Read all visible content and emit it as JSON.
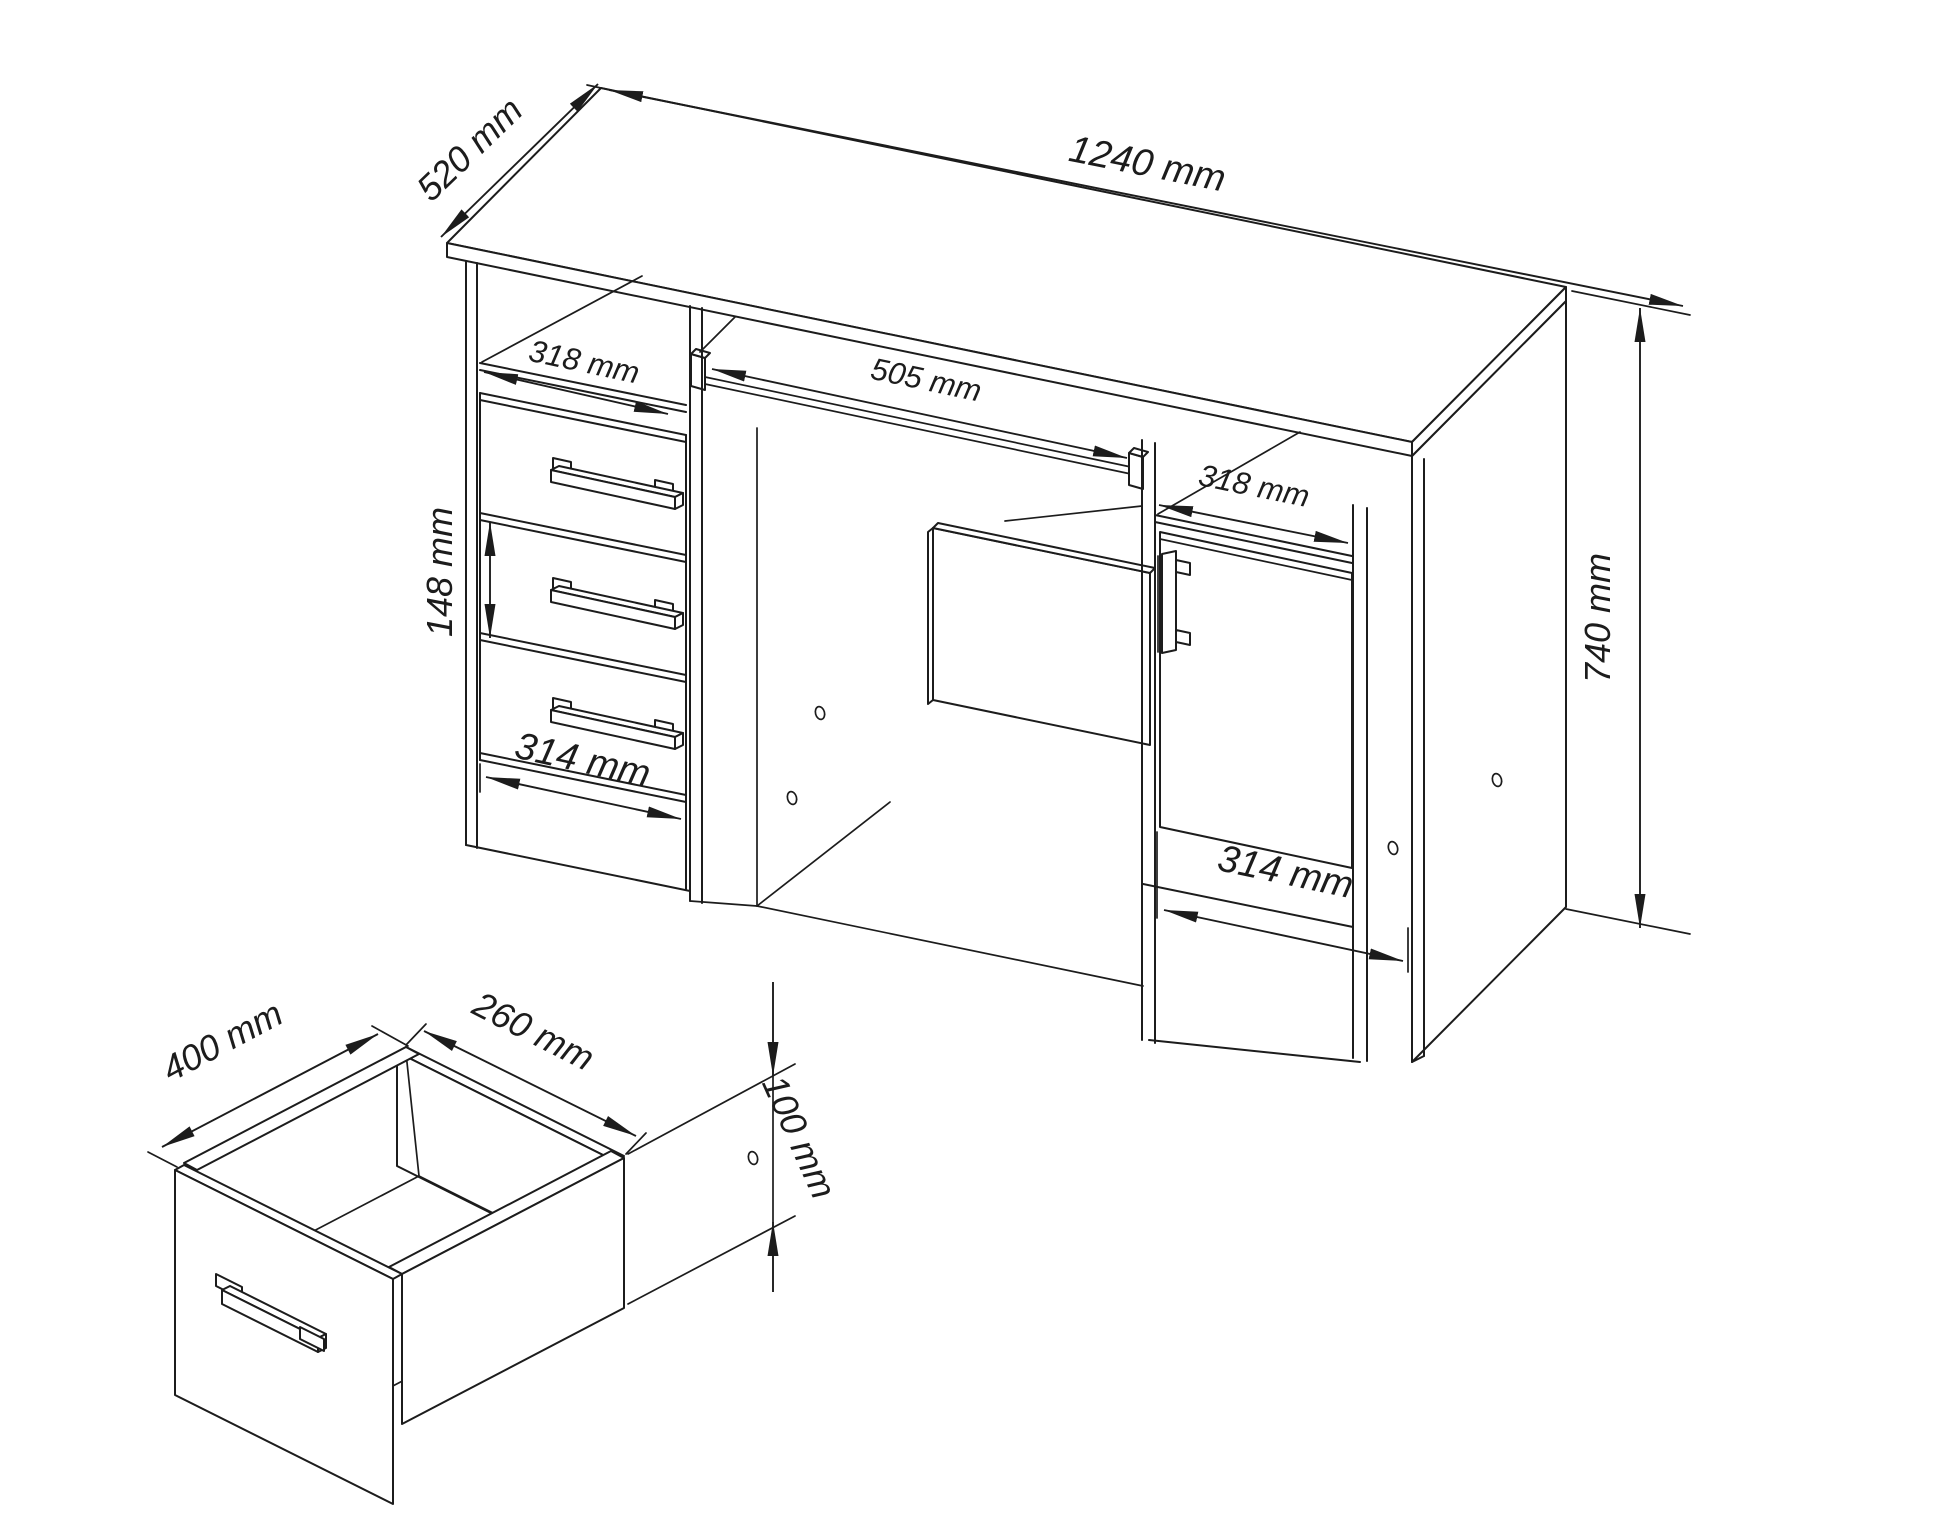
{
  "drawing": {
    "desk": {
      "width_label": "1240 mm",
      "depth_label": "520 mm",
      "height_label": "740 mm",
      "left_shelf_width_label": "318 mm",
      "tray_width_label": "505 mm",
      "right_shelf_width_label": "318 mm",
      "drawer_pitch_label": "148 mm",
      "drawer_front_width_label": "314 mm",
      "door_width_label": "314 mm"
    },
    "drawer_detail": {
      "depth_label": "400 mm",
      "width_label": "260 mm",
      "height_label": "100 mm"
    }
  }
}
